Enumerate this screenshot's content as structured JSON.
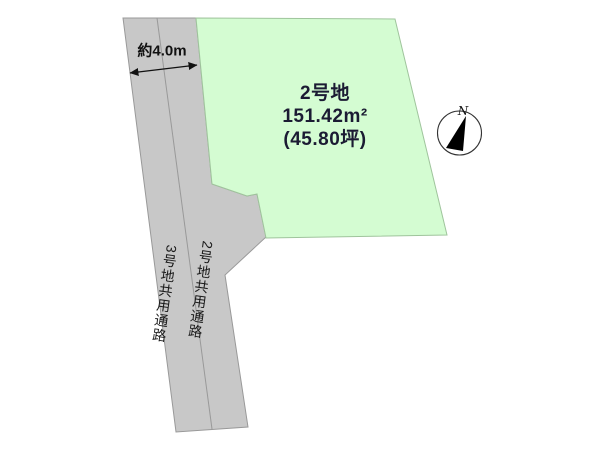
{
  "diagram": {
    "background": "#ffffff",
    "dimension": {
      "label": "約4.0m"
    },
    "plot": {
      "name": "2号地",
      "area_m2": "151.42m²",
      "area_tsubo": "(45.80坪)",
      "fill": "#d4fcd2",
      "stroke": "#9fc49c"
    },
    "roads": {
      "fill": "#c8c8c8",
      "stroke": "#999999",
      "center_line_color": "#999999",
      "left_label": "3号地共用通路",
      "right_label": "2号地共用通路"
    },
    "compass": {
      "label": "N",
      "needle_color": "#000000",
      "ring_color": "#333333"
    },
    "arrow_color": "#111111"
  }
}
